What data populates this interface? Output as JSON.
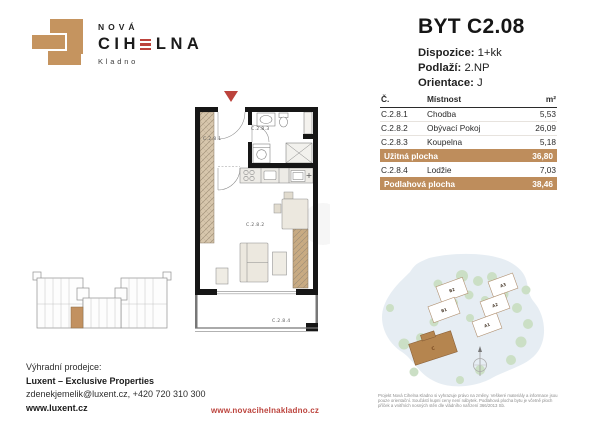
{
  "brand": {
    "nova": "NOVÁ",
    "cihelna_pre": "CIH",
    "cihelna_post": "LNA",
    "city": "Kladno"
  },
  "header": {
    "title": "BYT C2.08",
    "specs": [
      {
        "label": "Dispozice:",
        "value": "1+kk"
      },
      {
        "label": "Podlaží:",
        "value": "2.NP"
      },
      {
        "label": "Orientace:",
        "value": "J"
      }
    ]
  },
  "room_table": {
    "headers": {
      "num": "Č.",
      "room": "Místnost",
      "area": "m²"
    },
    "rows": [
      {
        "num": "C.2.8.1",
        "room": "Chodba",
        "area": "5,53"
      },
      {
        "num": "C.2.8.2",
        "room": "Obývací Pokoj",
        "area": "26,09"
      },
      {
        "num": "C.2.8.3",
        "room": "Koupelna",
        "area": "5,18"
      }
    ],
    "subtotal": {
      "label": "Užitná plocha",
      "area": "36,80"
    },
    "extra": {
      "num": "C.2.8.4",
      "room": "Lodžie",
      "area": "7,03"
    },
    "total": {
      "label": "Podlahová plocha",
      "area": "38,46"
    }
  },
  "floorplan": {
    "rooms": {
      "hall": "C.2.8.1",
      "living": "C.2.8.2",
      "bath": "C.2.8.3",
      "loggia": "C.2.8.4"
    }
  },
  "site_plan": {
    "buildings": [
      {
        "label": "B2"
      },
      {
        "label": "B1"
      },
      {
        "label": "A3"
      },
      {
        "label": "A2"
      },
      {
        "label": "A1"
      }
    ],
    "highlighted": {
      "label": "C"
    }
  },
  "footer": {
    "seller_label": "Výhradní prodejce:",
    "seller_name": "Luxent – Exclusive Properties",
    "seller_contact": "zdenekjemelik@luxent.cz, +420 720 310 300",
    "seller_web": "www.luxent.cz",
    "project_web": "www.novacihelnakladno.cz",
    "disclaimer": "Projekt Nová Cihelna Kladno si vyhrazuje právo na změny. Veškeré materiály a informace jsou pouze orientační. Součástí kupní ceny není nábytek. Podlahová plocha bytu je včetně ploch příček a vnitřních nosných stěn dle vládního nařízení 366/2013 Sb."
  },
  "colors": {
    "brand_tan": "#C29160",
    "table_highlight": "#BE8D5C",
    "brand_red": "#BC433C",
    "text_dark": "#1D1D1B"
  }
}
